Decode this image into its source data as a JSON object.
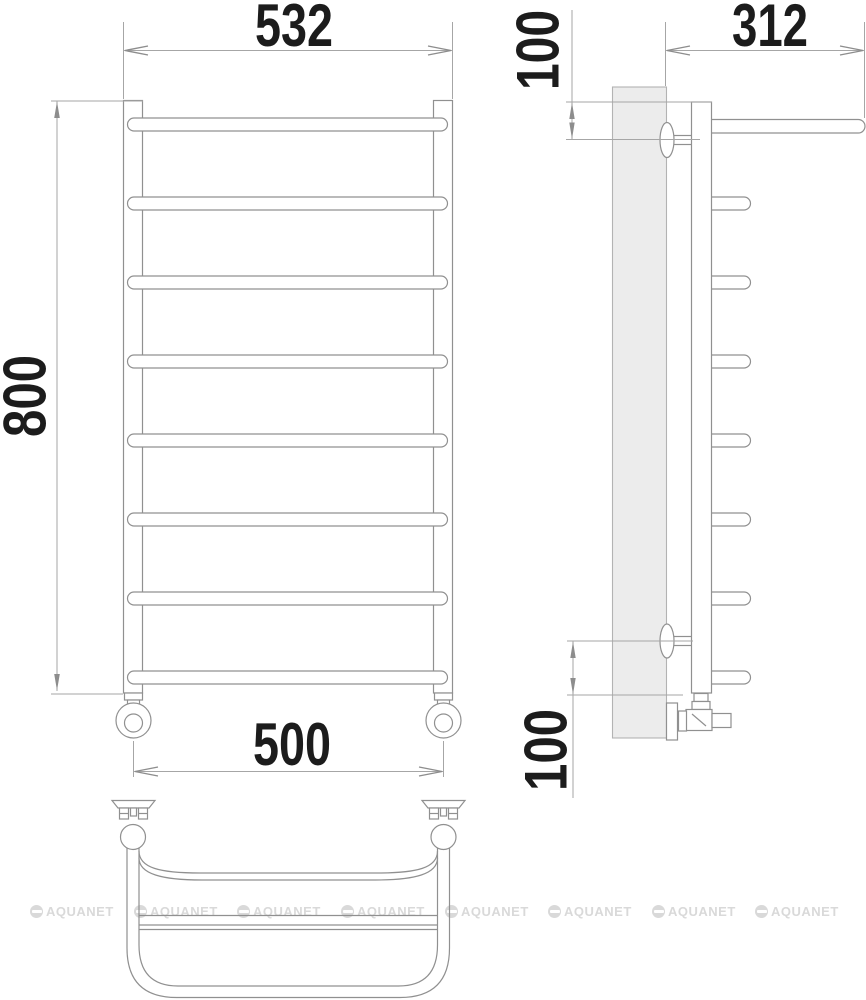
{
  "title": "Heated towel rail technical drawing",
  "labels": {
    "front_width": "532",
    "front_height": "800",
    "bottom_width": "500",
    "side_depth": "312",
    "side_top_offset": "100",
    "side_bottom_offset": "100"
  },
  "views": {
    "front": "front view - 8 rung ladder towel rail",
    "side": "side view - wall mounted profile with shelf",
    "bottom": "bottom view - curved shelf frame"
  },
  "watermark": {
    "text": "AQUANET"
  },
  "colors": {
    "line": "#909090",
    "extension_line": "#a6a6a6",
    "dimension_text": "#1c1c1c",
    "wall_fill": "#ececec",
    "watermark": "#d9d9d9",
    "background": "#ffffff"
  }
}
